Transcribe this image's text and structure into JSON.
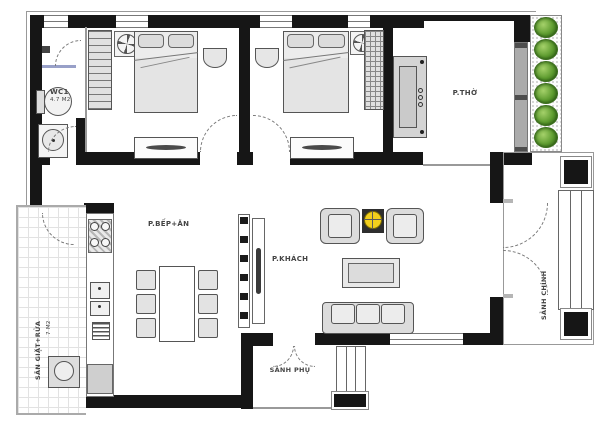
{
  "plan_title": "house floor plan",
  "rooms": {
    "wc": {
      "name": "WC1",
      "area": "4.7 M2"
    },
    "worship": {
      "name": "P.THỜ"
    },
    "kitchen_dining": {
      "name": "P.BẾP+ĂN"
    },
    "living": {
      "name": "P.KHÁCH"
    },
    "main_hall": {
      "name": "SẢNH CHÍNH"
    },
    "side_hall": {
      "name": "SẢNH PHỤ"
    },
    "laundry_yard": {
      "name": "SÂN GIẶT+RỬA",
      "area": "7 M2"
    }
  },
  "colors": {
    "wall": "#161616",
    "plant_green": "#5c9a2e",
    "side_table_yellow": "#f2cf1d",
    "window_gray": "#ababab"
  }
}
